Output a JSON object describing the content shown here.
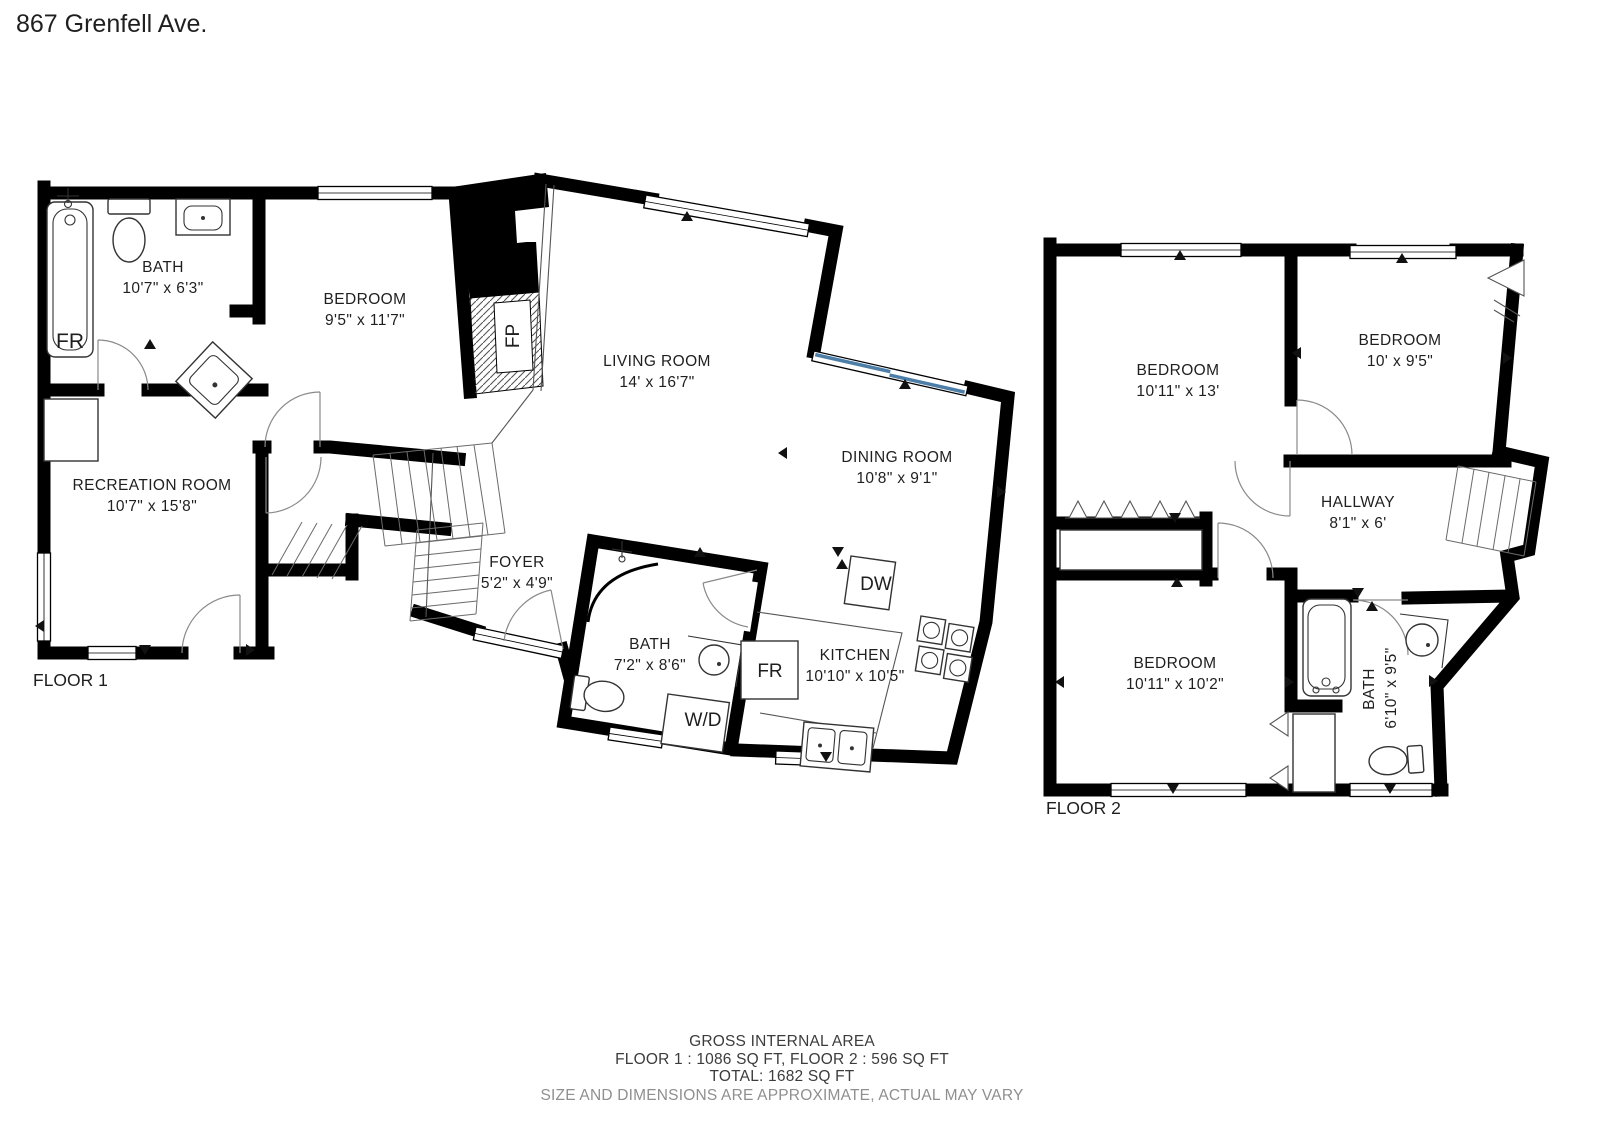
{
  "title": "867 Grenfell Ave.",
  "floor1": {
    "label": "FLOOR 1",
    "rooms": [
      {
        "name": "BATH",
        "dims": "10'7\" x 6'3\""
      },
      {
        "name": "BEDROOM",
        "dims": "9'5\" x 11'7\""
      },
      {
        "name": "RECREATION ROOM",
        "dims": "10'7\" x 15'8\""
      },
      {
        "name": "LIVING ROOM",
        "dims": "14' x 16'7\""
      },
      {
        "name": "DINING ROOM",
        "dims": "10'8\" x 9'1\""
      },
      {
        "name": "FOYER",
        "dims": "5'2\" x 4'9\""
      },
      {
        "name": "BATH",
        "dims": "7'2\" x 8'6\""
      },
      {
        "name": "KITCHEN",
        "dims": "10'10\" x 10'5\""
      }
    ],
    "fixtures": {
      "basement_freezer": "FR",
      "fireplace": "FP",
      "dishwasher": "DW",
      "kitchen_fridge": "FR",
      "washer_dryer": "W/D"
    }
  },
  "floor2": {
    "label": "FLOOR 2",
    "rooms": [
      {
        "name": "BEDROOM",
        "dims": "10'11\" x 13'"
      },
      {
        "name": "BEDROOM",
        "dims": "10' x 9'5\""
      },
      {
        "name": "HALLWAY",
        "dims": "8'1\" x 6'"
      },
      {
        "name": "BEDROOM",
        "dims": "10'11\" x 10'2\""
      },
      {
        "name": "BATH",
        "dims": "6'10\" x 9'5\""
      }
    ]
  },
  "footer": {
    "line1": "GROSS INTERNAL AREA",
    "line2": "FLOOR 1 : 1086 SQ FT, FLOOR 2 : 596 SQ FT",
    "line3": "TOTAL: 1682 SQ FT",
    "disclaimer": "SIZE AND DIMENSIONS ARE APPROXIMATE, ACTUAL MAY VARY"
  },
  "colors": {
    "wall": "#000000",
    "window_accent": "#4d7ea8",
    "disclaimer_text": "#8f8f8f"
  }
}
